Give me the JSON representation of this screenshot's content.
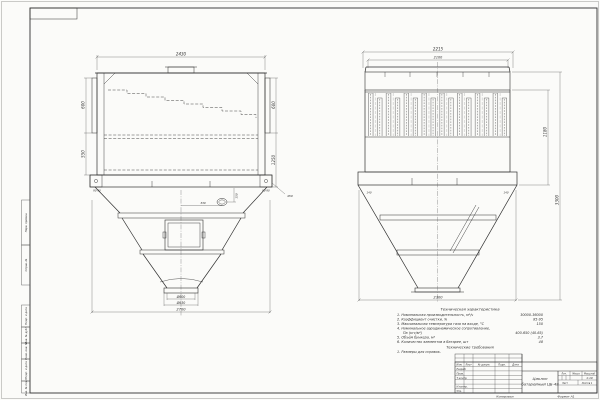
{
  "drawing": {
    "left_view": {
      "dims": {
        "width_top": "2430",
        "left_upper": "600",
        "left_lower": "550",
        "right_upper": "600",
        "right_lower": "1250",
        "corner_left": "90  90",
        "corner_right": "90  90",
        "leader_note": "450",
        "fitting_height": "150",
        "fitting_offset": "330",
        "outlet_inner": "Ø600",
        "outlet_flange": "Ø630",
        "width_bottom": "2700"
      }
    },
    "right_view": {
      "dims": {
        "width_top_outer": "2215",
        "width_top_inner": "2100",
        "corner_left": "140",
        "corner_right": "140",
        "height_inner": "1180",
        "height_overall": "3300",
        "width_bottom": "2300"
      }
    },
    "tech_chars": {
      "title": "Техническая характеристика",
      "items": [
        {
          "label": "1. Номинальная производительность, м³/ч",
          "value": "30000-36000"
        },
        {
          "label": "2. Коэффициент очистки, %",
          "value": "85-95"
        },
        {
          "label": "3. Максимальная температура газа на входе, °С",
          "value": "150"
        },
        {
          "label": "4. Номинальное аэродинамическое сопротивление,",
          "value": ""
        },
        {
          "label": "Па (кгс/м²)",
          "value": "400-650 (40-65)"
        },
        {
          "label": "5. Объём бункера, м³",
          "value": "3,7"
        },
        {
          "label": "6. Количество элементов в батарее, шт",
          "value": "48"
        }
      ],
      "requirements_title": "Технические требования",
      "requirement_1": "1. Размеры для справок."
    },
    "title_block": {
      "doc_name_line1": "Циклон",
      "doc_name_line2": "батарейный ЦБ-48",
      "scale": "1:10",
      "col_izm": "Изм.",
      "col_list": "Лист",
      "col_doc": "№ докум.",
      "col_sign": "Подп.",
      "col_date": "Дата",
      "row_developed": "Разраб.",
      "row_checked": "Пров.",
      "row_tcontrol": "Т.контр.",
      "row_ncontrol": "Н.контр.",
      "row_approved": "Утв.",
      "lit_label": "Лит.",
      "mass_label": "Масса",
      "scale_label": "Масштаб",
      "sheet_label": "Лист",
      "sheets_label": "Листов 1",
      "copied_label": "Копировал",
      "format_label": "Формат А1"
    },
    "margin_stamps": [
      "Перв. примен.",
      "Справ. №",
      "Подп. и дата",
      "Инв. № дубл.",
      "Взам. инв. №",
      "Подп. и дата",
      "Инв. № подл."
    ]
  }
}
